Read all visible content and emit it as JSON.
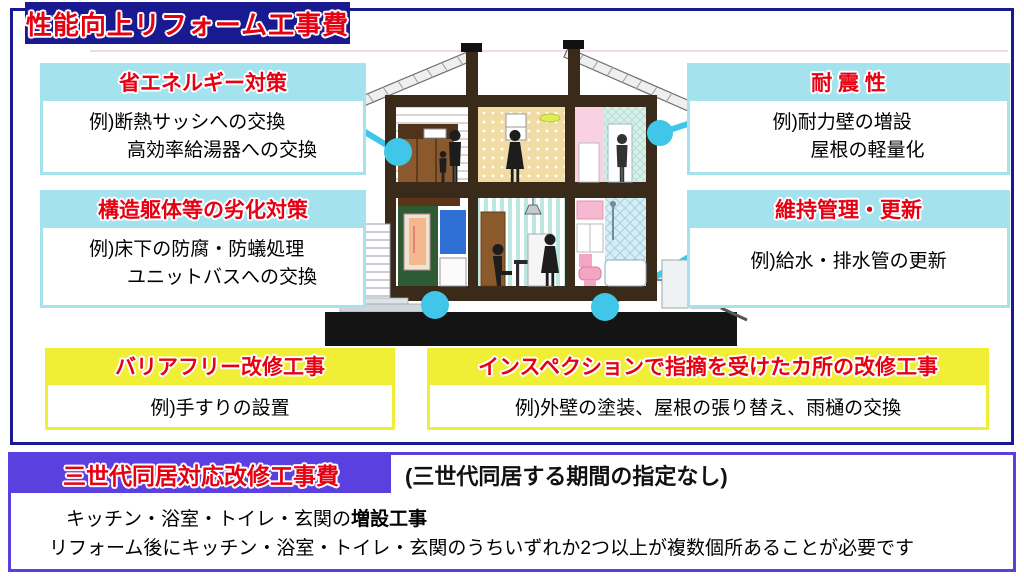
{
  "top": {
    "title": "性能向上リフォーム工事費",
    "energy": {
      "header": "省エネルギー対策",
      "line1": "例)断熱サッシへの交換",
      "line2": "高効率給湯器への交換"
    },
    "seismic": {
      "header": "耐 震 性",
      "line1": "例)耐力壁の増設",
      "line2": "屋根の軽量化"
    },
    "deterioration": {
      "header": "構造躯体等の劣化対策",
      "line1": "例)床下の防腐・防蟻処理",
      "line2": "ユニットバスへの交換"
    },
    "maintenance": {
      "header": "維持管理・更新",
      "line1": "例)給水・排水管の更新"
    },
    "barrier_free": {
      "header": "バリアフリー改修工事",
      "line1": "例)手すりの設置"
    },
    "inspection": {
      "header": "インスペクションで指摘を受けたカ所の改修工事",
      "line1": "例)外壁の塗装、屋根の張り替え、雨樋の交換"
    }
  },
  "bottom": {
    "title": "三世代同居対応改修工事費",
    "subtitle": "(三世代同居する期間の指定なし)",
    "line1_normal": "キッチン・浴室・トイレ・玄関の",
    "line1_bold": "増設工事",
    "line2": "リフォーム後にキッチン・浴室・トイレ・玄関のうちいずれか2つ以上が複数個所あることが必要です"
  },
  "colors": {
    "navy": "#1a1a90",
    "red": "#e60012",
    "cyan": "#a4e2ee",
    "yellow": "#f1ef35",
    "violet": "#5b40e0",
    "connector": "#40c6e8"
  }
}
